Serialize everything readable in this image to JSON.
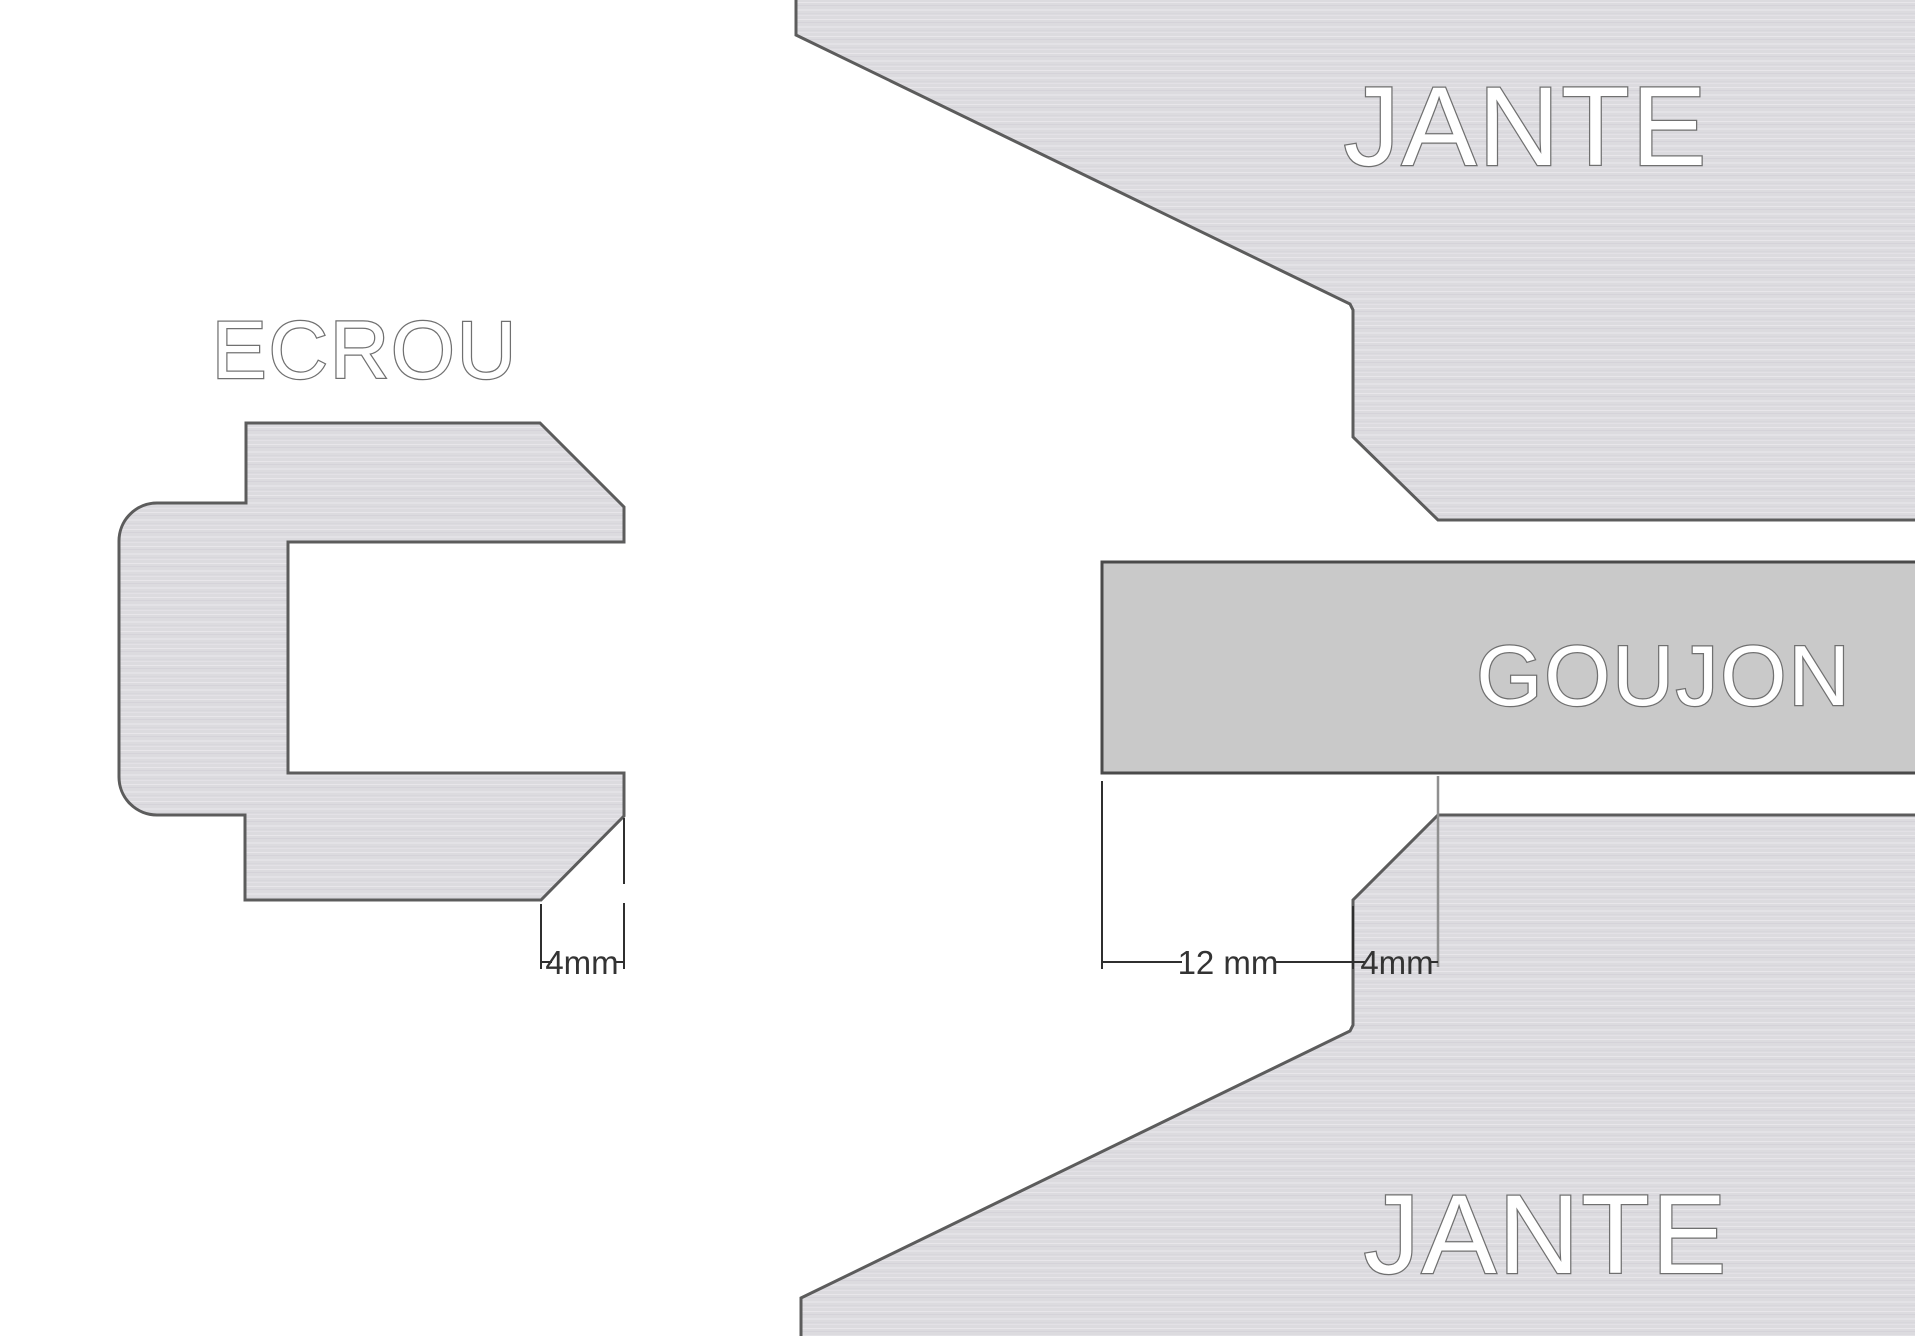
{
  "labels": {
    "ecrou": "ECROU",
    "jante_top": "JANTE",
    "jante_bottom": "JANTE",
    "goujon": "GOUJON"
  },
  "dimensions": {
    "ecrou_chamfer": "4mm",
    "goujon_protrusion": "12 mm",
    "jante_chamfer": "4mm"
  },
  "colors": {
    "background": "#ffffff",
    "part_fill_base": "#dcdbdf",
    "part_outline": "#5c5c5c",
    "goujon_fill": "#c9c9c9",
    "goujon_outline": "#4a4a4a",
    "dimension_line": "#2f2f2f",
    "dimension_text": "#333333",
    "label_fill": "#ffffff",
    "label_outline": "#707070"
  }
}
